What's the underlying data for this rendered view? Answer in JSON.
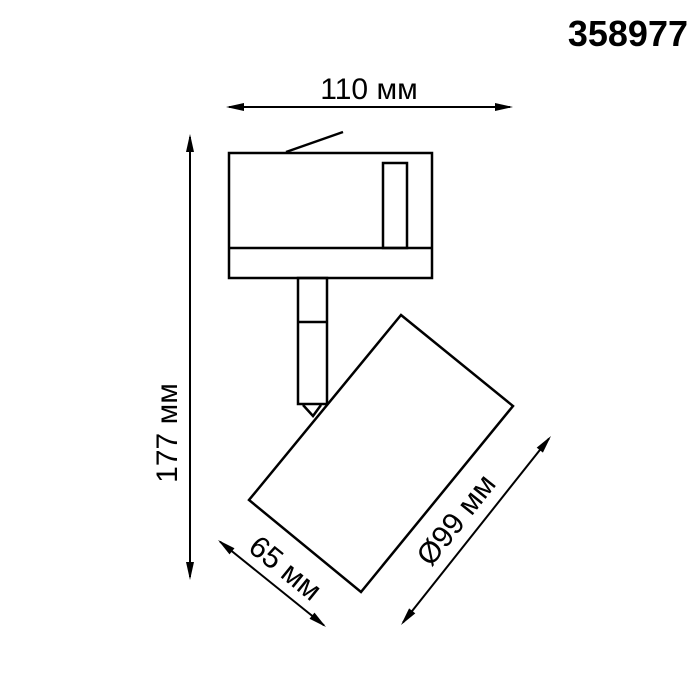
{
  "product_code": "358977",
  "dimensions": {
    "width": {
      "label": "110 мм",
      "value_mm": 110
    },
    "height": {
      "label": "177 мм",
      "value_mm": 177
    },
    "head_width": {
      "label": "65 мм",
      "value_mm": 65
    },
    "head_diameter": {
      "label": "Ø99 мм",
      "value_mm": 99
    }
  },
  "colors": {
    "ink": "#000000",
    "background": "#ffffff"
  }
}
